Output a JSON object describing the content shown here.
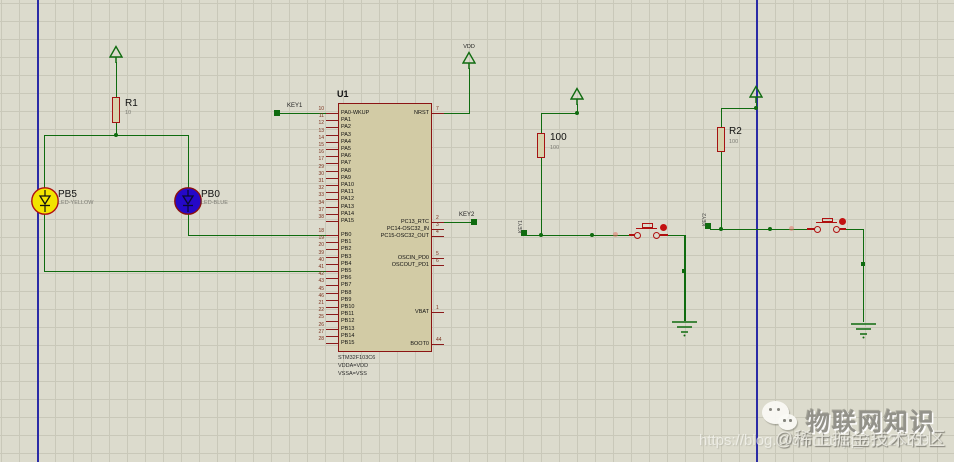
{
  "canvas": {
    "wire_color": "#0f6b0f",
    "component_color": "#b01010",
    "sheet_border_color": "#2b2ba6",
    "background": "#dcdbcd"
  },
  "chip": {
    "ref": "U1",
    "part": "STM32F103C6",
    "note1": "VDDA=VDD",
    "note2": "VSSA=VSS",
    "left_pins": [
      {
        "num": "10",
        "name": "PA0-WKUP",
        "y": 113
      },
      {
        "num": "11",
        "name": "PA1",
        "y": 120
      },
      {
        "num": "12",
        "name": "PA2",
        "y": 127
      },
      {
        "num": "13",
        "name": "PA3",
        "y": 135
      },
      {
        "num": "14",
        "name": "PA4",
        "y": 142
      },
      {
        "num": "15",
        "name": "PA5",
        "y": 149
      },
      {
        "num": "16",
        "name": "PA6",
        "y": 156
      },
      {
        "num": "17",
        "name": "PA7",
        "y": 163
      },
      {
        "num": "29",
        "name": "PA8",
        "y": 171
      },
      {
        "num": "30",
        "name": "PA9",
        "y": 178
      },
      {
        "num": "31",
        "name": "PA10",
        "y": 185
      },
      {
        "num": "32",
        "name": "PA11",
        "y": 192
      },
      {
        "num": "33",
        "name": "PA12",
        "y": 199
      },
      {
        "num": "34",
        "name": "PA13",
        "y": 207
      },
      {
        "num": "37",
        "name": "PA14",
        "y": 214
      },
      {
        "num": "38",
        "name": "PA15",
        "y": 221
      },
      {
        "num": "18",
        "name": "PB0",
        "y": 235
      },
      {
        "num": "19",
        "name": "PB1",
        "y": 242
      },
      {
        "num": "20",
        "name": "PB2",
        "y": 249
      },
      {
        "num": "39",
        "name": "PB3",
        "y": 257
      },
      {
        "num": "40",
        "name": "PB4",
        "y": 264
      },
      {
        "num": "41",
        "name": "PB5",
        "y": 271
      },
      {
        "num": "42",
        "name": "PB6",
        "y": 278
      },
      {
        "num": "43",
        "name": "PB7",
        "y": 285
      },
      {
        "num": "45",
        "name": "PB8",
        "y": 293
      },
      {
        "num": "46",
        "name": "PB9",
        "y": 300
      },
      {
        "num": "21",
        "name": "PB10",
        "y": 307
      },
      {
        "num": "22",
        "name": "PB11",
        "y": 314
      },
      {
        "num": "25",
        "name": "PB12",
        "y": 321
      },
      {
        "num": "26",
        "name": "PB13",
        "y": 329
      },
      {
        "num": "27",
        "name": "PB14",
        "y": 336
      },
      {
        "num": "28",
        "name": "PB15",
        "y": 343
      }
    ],
    "right_pins": [
      {
        "num": "7",
        "name": "NRST",
        "y": 113
      },
      {
        "num": "2",
        "name": "PC13_RTC",
        "y": 222
      },
      {
        "num": "3",
        "name": "PC14-OSC32_IN",
        "y": 229
      },
      {
        "num": "4",
        "name": "PC15-OSC32_OUT",
        "y": 236
      },
      {
        "num": "5",
        "name": "OSCIN_PD0",
        "y": 258
      },
      {
        "num": "6",
        "name": "OSCOUT_PD1",
        "y": 265
      },
      {
        "num": "1",
        "name": "VBAT",
        "y": 312
      },
      {
        "num": "44",
        "name": "BOOT0",
        "y": 344
      }
    ]
  },
  "components": {
    "r1": {
      "ref": "R1",
      "value": "10"
    },
    "r_key1": {
      "ref": "100",
      "value": "100"
    },
    "r2": {
      "ref": "R2",
      "value": "100"
    },
    "led_yellow": {
      "ref": "PB5",
      "type": "LED-YELLOW"
    },
    "led_blue": {
      "ref": "PB0",
      "type": "LED-BLUE"
    }
  },
  "net_labels": {
    "key1": "KEY1",
    "key2": "KEY2",
    "vdd": "VDD",
    "key1_terminal": "KEY1",
    "key2_terminal": "KEY2"
  },
  "watermark": {
    "title": "物联网知识",
    "community": "@稀土掘金技术社区",
    "url": "https://blog.csdn.net/qq_41025159",
    "icon": "wechat-logo"
  }
}
